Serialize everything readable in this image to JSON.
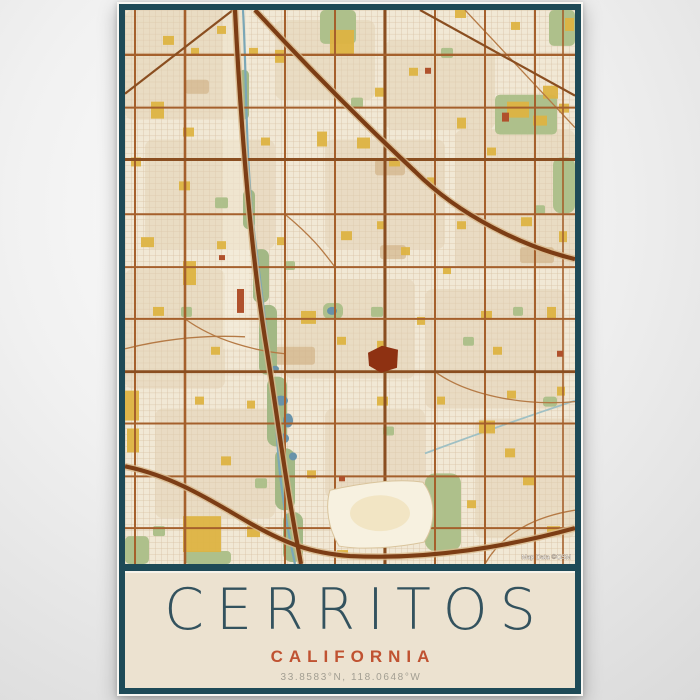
{
  "poster": {
    "title": "CERRITOS",
    "subtitle": "CALIFORNIA",
    "coordinates": "33.8583°N, 118.0648°W",
    "map": {
      "attribution": "Map Data ©OSM"
    },
    "colors": {
      "frame_teal": "#1e4a57",
      "paper_cream": "#ece2d0",
      "title_text": "#33525e",
      "subtitle_text": "#c05231",
      "coordinates_text": "#a29e92",
      "map_background": "#f1e8d5",
      "map_streets": "#a5602c",
      "map_freeways": "#7c3d15",
      "map_parks": "#aec08b",
      "map_water": "#7ba7b7",
      "map_landmark_gold": "#ddb342",
      "map_landmark_red": "#8e3112"
    }
  }
}
